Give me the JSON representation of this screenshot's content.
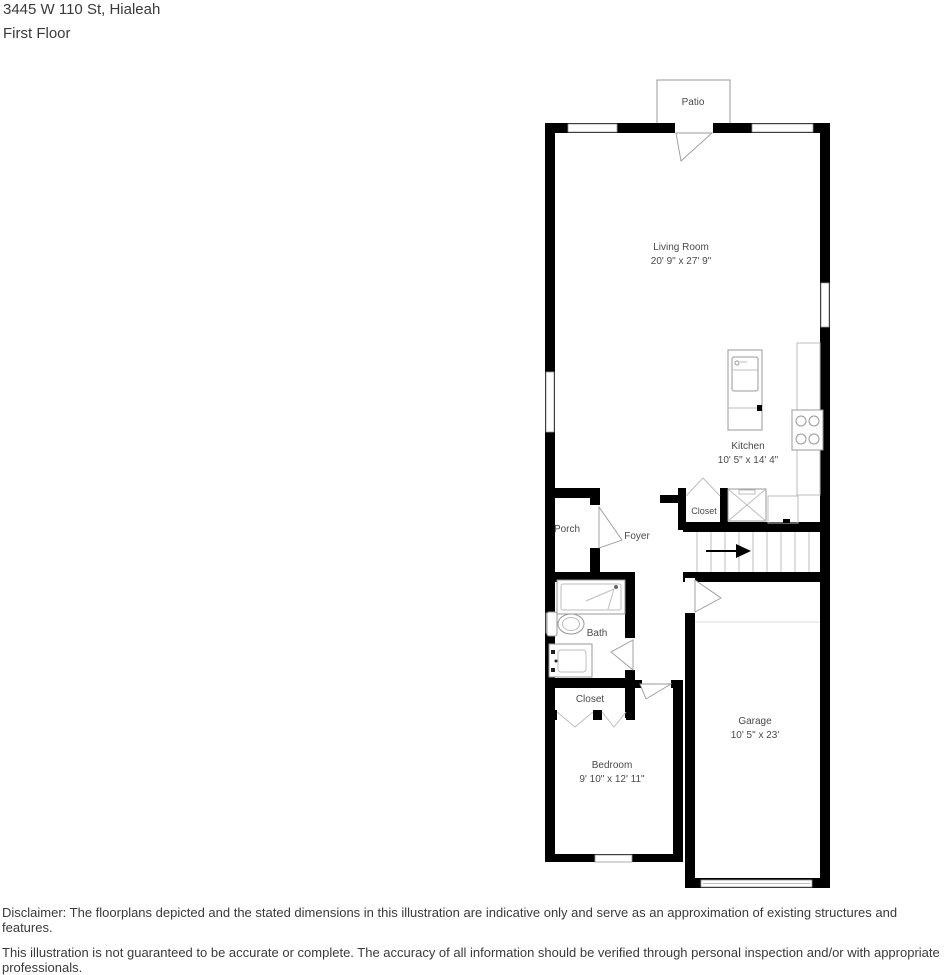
{
  "header": {
    "address": "3445 W 110 St, Hialeah",
    "floor_label": "First Floor"
  },
  "rooms": {
    "patio": {
      "name": "Patio"
    },
    "living_room": {
      "name": "Living Room",
      "dims": "20' 9\" x 27' 9\""
    },
    "kitchen": {
      "name": "Kitchen",
      "dims": "10' 5\" x 14' 4\""
    },
    "kitchen_closet": {
      "name": "Closet"
    },
    "porch": {
      "name": "Porch"
    },
    "foyer": {
      "name": "Foyer"
    },
    "bath": {
      "name": "Bath"
    },
    "bedroom_closet": {
      "name": "Closet"
    },
    "bedroom": {
      "name": "Bedroom",
      "dims": "9' 10\" x 12' 11\""
    },
    "garage": {
      "name": "Garage",
      "dims": "10' 5\" x 23'"
    }
  },
  "disclaimer": {
    "line1": "Disclaimer: The floorplans depicted and the stated dimensions in this illustration are indicative only and serve as an approximation of existing structures and features.",
    "line2": "This illustration is not guaranteed to be accurate or complete. The accuracy of all information should be verified through personal inspection and/or with appropriate professionals."
  },
  "colors": {
    "wall": "#000000",
    "fixture": "#999999",
    "fixture_light": "#bdbdbd",
    "label_text": "#4a4a4a",
    "text_main": "#3a3a3a",
    "bg": "#ffffff"
  }
}
